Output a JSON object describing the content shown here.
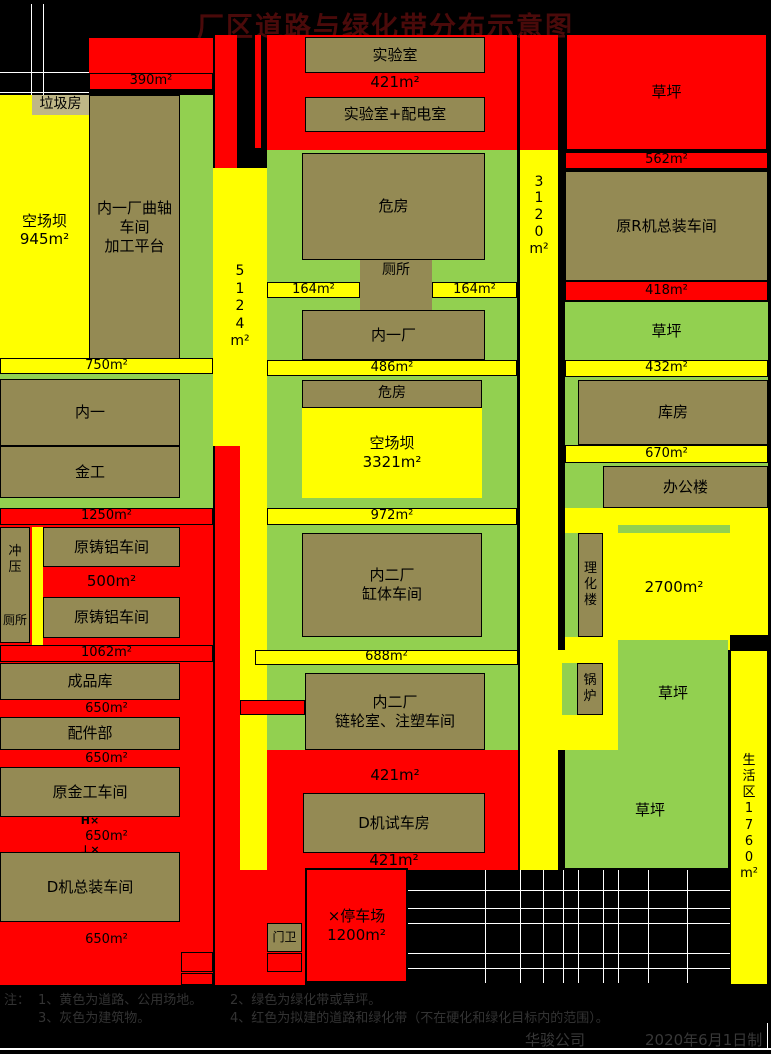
{
  "title": "厂区道路与绿化带分布示意图",
  "palette": {
    "road_existing_yellow": "#FFFF00",
    "road_planned_red": "#FF0000",
    "greenbelt_green": "#92D050",
    "building_olive": "#948A54",
    "label_tan": "#BFB786",
    "background_black": "#000000",
    "grid_line_white": "#FFFFFF",
    "title_dark_red": "#4A0A0A"
  },
  "map": {
    "top_left": {
      "trash_room": "垃圾房",
      "road_390": "390m²",
      "open_yard": "空场坝\n945m²",
      "crankshaft_workshop": "内一厂曲轴\n车间\n加工平台",
      "road_5124": "5\n1\n2\n4\nm²"
    },
    "top_center": {
      "laboratory": "实验室",
      "road_421": "421m²",
      "lab_power_room": "实验室+配电室",
      "dilapidated_house": "危房",
      "toilet": "厕所",
      "road_164_left": "164m²",
      "road_164_right": "164m²",
      "plant_one": "内一厂",
      "road_3120": "3\n1\n2\n0\nm²"
    },
    "top_right": {
      "lawn_planned": "草坪",
      "road_562": "562m²",
      "r_machine_assembly": "原R机总装车间",
      "road_418": "418m²",
      "lawn": "草坪"
    },
    "mid_left": {
      "road_750": "750m²",
      "nei_yi": "内一",
      "jin_gong": "金工",
      "road_1250": "1250m²",
      "stamping": "冲\n压",
      "toilet": "厕所",
      "cast_aluminum_1": "原铸铝车间",
      "road_500": "500m²",
      "cast_aluminum_2": "原铸铝车间",
      "road_1062": "1062m²"
    },
    "mid_center": {
      "road_486": "486m²",
      "dilapidated_house": "危房",
      "open_yard": "空场坝\n3321m²",
      "road_972": "972m²",
      "cylinder_workshop": "内二厂\n缸体车间",
      "road_688": "688m²"
    },
    "mid_right": {
      "road_432": "432m²",
      "warehouse": "库房",
      "road_670": "670m²",
      "office_building": "办公楼",
      "physchem_building": "理\n化\n楼",
      "road_2700": "2700m²"
    },
    "bottom_left": {
      "finished_goods_store": "成品库",
      "road_650_1": "650m²",
      "parts_department": "配件部",
      "road_650_2": "650m²",
      "metalwork_workshop": "原金工车间",
      "mark_top": "H×",
      "road_650_3": "650m²",
      "mark_bottom": "⊥×",
      "d_assembly_workshop": "D机总装车间",
      "road_650_4": "650m²"
    },
    "bottom_center": {
      "sprocket_workshop": "内二厂\n链轮室、注塑车间",
      "road_421_upper": "421m²",
      "d_test_house": "D机试车房",
      "road_421_lower": "421m²",
      "parking": "×停车场\n1200m²",
      "gatehouse": "门卫"
    },
    "bottom_right": {
      "boiler": "锅\n炉",
      "lawn_upper": "草坪",
      "lawn_lower": "草坪",
      "living_area": "生\n活\n区\n1\n7\n6\n0\nm²"
    }
  },
  "notes": {
    "prefix": "注：",
    "item1": "1、黄色为道路、公用场地。",
    "item2": "2、绿色为绿化带或草坪。",
    "item3": "3、灰色为建筑物。",
    "item4": "4、红色为拟建的道路和绿化带（不在硬化和绿化目标内的范围）。"
  },
  "footer": {
    "company": "华骏公司",
    "date": "2020年6月1日制"
  }
}
